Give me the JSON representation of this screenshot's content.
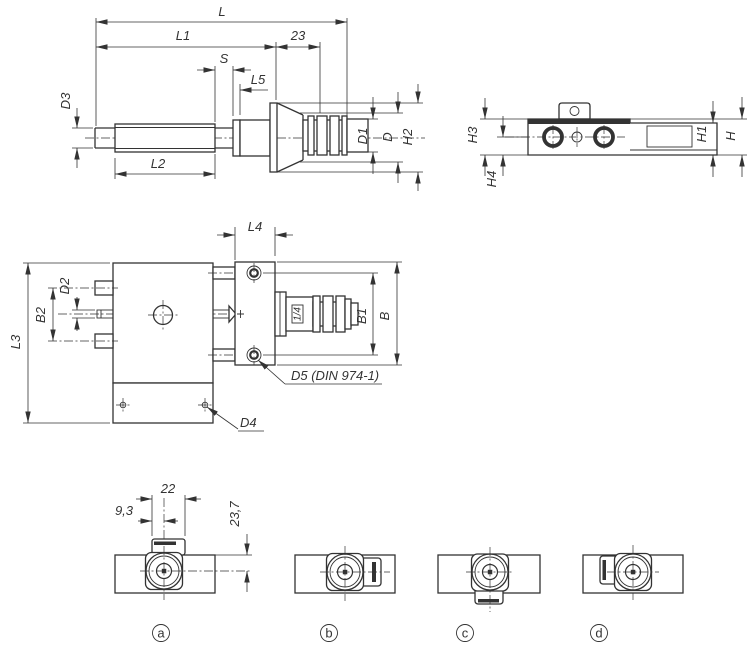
{
  "colors": {
    "line": "#333333",
    "background": "#ffffff"
  },
  "drawing": {
    "shaft_view": {
      "dims": {
        "L": "L",
        "L1": "L1",
        "offset23": "23",
        "S": "S",
        "L5": "L5",
        "D3": "D3",
        "L2": "L2",
        "D1": "D1",
        "D": "D",
        "H2": "H2"
      }
    },
    "side_view": {
      "dims": {
        "H3": "H3",
        "H4": "H4",
        "H1": "H1",
        "H": "H"
      }
    },
    "top_view": {
      "dims": {
        "L4": "L4",
        "D2": "D2",
        "B2": "B2",
        "L3": "L3",
        "B1": "B1",
        "B": "B",
        "D4": "D4",
        "D5": "D5 (DIN 974-1)"
      },
      "port": "1/4"
    },
    "variant_view": {
      "dims": {
        "width22": "22",
        "width9_3": "9,3",
        "height23_7": "23,7"
      },
      "labels": {
        "a": "a",
        "b": "b",
        "c": "c",
        "d": "d"
      }
    }
  }
}
